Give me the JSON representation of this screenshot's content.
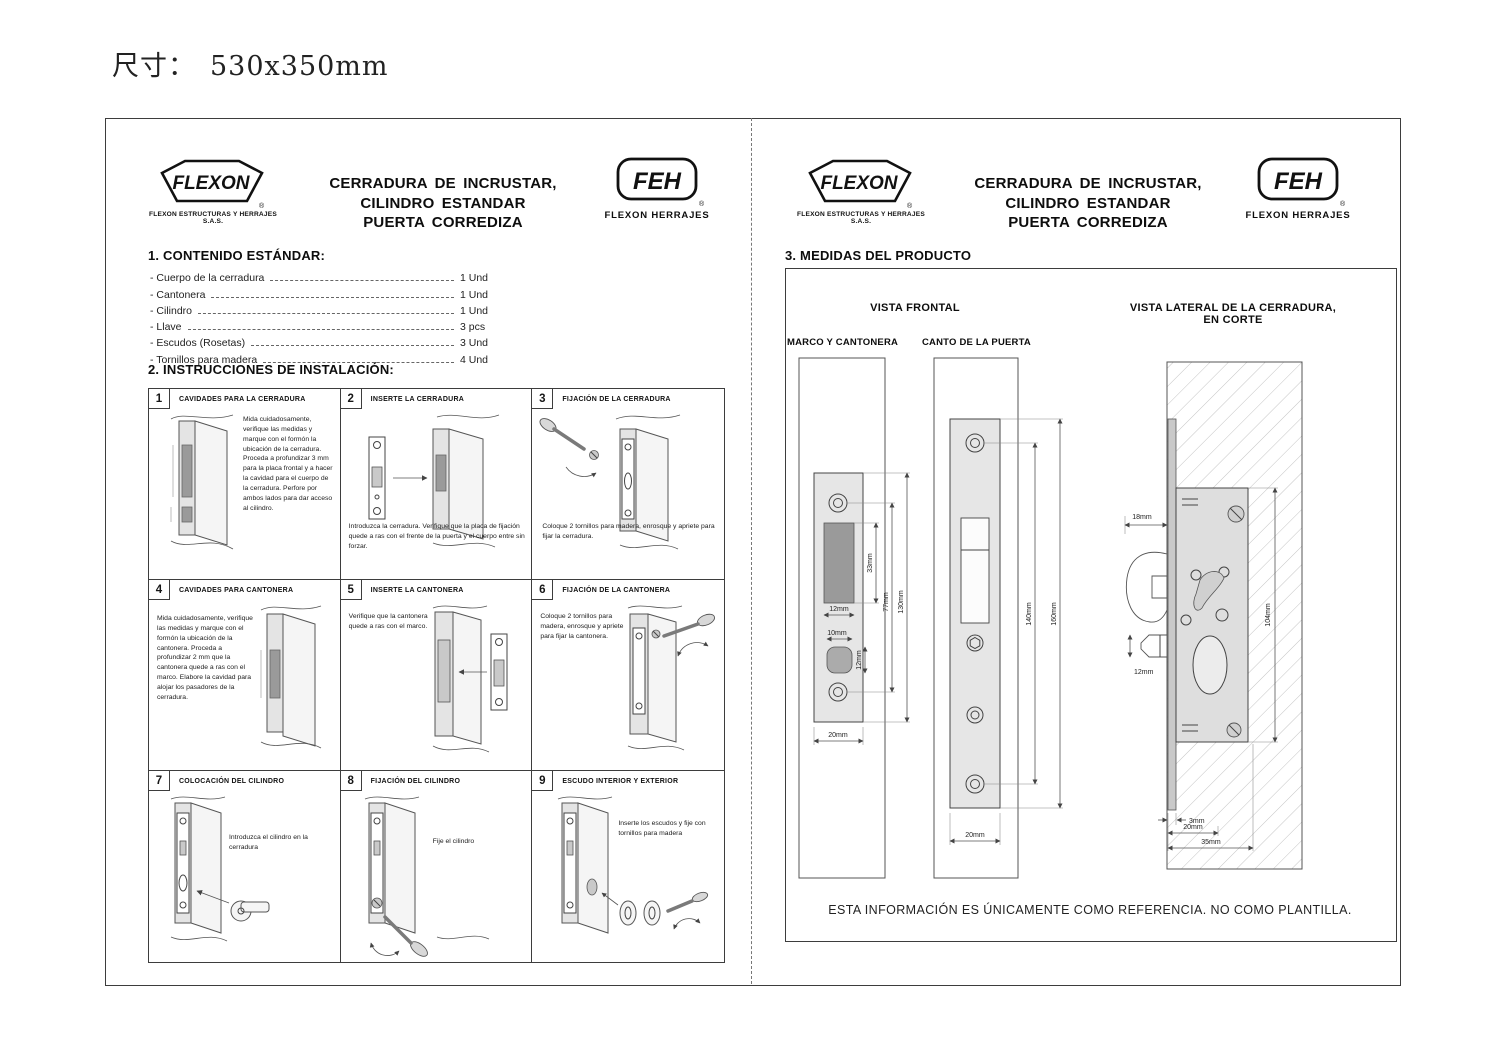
{
  "meta": {
    "size_label": "尺寸：",
    "size_value": "530x350mm"
  },
  "header": {
    "flexon_logo": "FLEXON",
    "flexon_sub": "FLEXON ESTRUCTURAS Y HERRAJES S.A.S.",
    "registered": "®",
    "title_line1": "CERRADURA DE INCRUSTAR,",
    "title_line2": "CILINDRO ESTANDAR",
    "title_line3": "PUERTA CORREDIZA",
    "feh_logo": "FEH",
    "feh_sub": "FLEXON HERRAJES"
  },
  "left_page": {
    "section1": {
      "title": "1. CONTENIDO ESTÁNDAR:",
      "items": [
        {
          "label": "Cuerpo de la cerradura",
          "qty": "1 Und"
        },
        {
          "label": "Cantonera",
          "qty": "1 Und"
        },
        {
          "label": "Cilindro",
          "qty": "1 Und"
        },
        {
          "label": "Llave",
          "qty": "3 pcs"
        },
        {
          "label": "Escudos (Rosetas)",
          "qty": "3 Und"
        },
        {
          "label": "Tornillos para madera",
          "qty": "4 Und"
        }
      ]
    },
    "section2": {
      "title": "2. INSTRUCCIONES DE INSTALACIÓN:",
      "steps": [
        {
          "num": "1",
          "title": "CAVIDADES PARA LA CERRADURA",
          "text": "Mida cuidadosamente, verifique las medidas y marque con el formón la ubicación de la cerradura. Proceda a profundizar 3 mm para la placa frontal y a hacer la cavidad para el cuerpo de la cerradura. Perfore por ambos lados para dar acceso al cilindro."
        },
        {
          "num": "2",
          "title": "INSERTE LA CERRADURA",
          "text": "Introduzca la cerradura. Verifique que la placa de fijación quede a ras con el frente de la puerta y el cuerpo entre sin forzar."
        },
        {
          "num": "3",
          "title": "FIJACIÓN DE LA CERRADURA",
          "text": "Coloque 2 tornillos para madera, enrosque y apriete para fijar la cerradura."
        },
        {
          "num": "4",
          "title": "CAVIDADES PARA CANTONERA",
          "text": "Mida cuidadosamente, verifique las medidas y marque con el formón la ubicación de la cantonera. Proceda a profundizar 2 mm que la cantonera quede a ras con el marco. Elabore la cavidad para alojar los pasadores de la cerradura."
        },
        {
          "num": "5",
          "title": "INSERTE LA CANTONERA",
          "text": "Verifique que la cantonera quede a ras con el marco."
        },
        {
          "num": "6",
          "title": "FIJACIÓN DE LA CANTONERA",
          "text": "Coloque 2 tornillos para madera, enrosque y apriete para fijar la cantonera."
        },
        {
          "num": "7",
          "title": "COLOCACIÓN DEL CILINDRO",
          "text": "Introduzca el cilindro en la cerradura"
        },
        {
          "num": "8",
          "title": "FIJACIÓN DEL CILINDRO",
          "text": "Fije el cilindro"
        },
        {
          "num": "9",
          "title": "ESCUDO INTERIOR Y EXTERIOR",
          "text": "Inserte los escudos y fije con tornillos para madera"
        }
      ]
    }
  },
  "right_page": {
    "section3_title": "3. MEDIDAS DEL PRODUCTO",
    "vista_frontal": "VISTA FRONTAL",
    "marco_label": "MARCO Y  CANTONERA",
    "canto_label": "CANTO DE LA PUERTA",
    "lateral_label_line1": "VISTA LATERAL DE LA CERRADURA,",
    "lateral_label_line2": "EN CORTE",
    "footer_note": "ESTA INFORMACIÓN ES ÚNICAMENTE COMO REFERENCIA. NO COMO PLANTILLA.",
    "dims": {
      "marco": {
        "slot_w": "12mm",
        "slot_h": "33mm",
        "screws_h": "77mm",
        "plate_h": "130mm",
        "hole_w": "10mm",
        "hole_h": "12mm",
        "plate_w": "20mm"
      },
      "canto": {
        "screws_h": "140mm",
        "plate_h": "160mm",
        "plate_w": "20mm"
      },
      "lateral": {
        "backset": "18mm",
        "latch_h": "12mm",
        "body_h": "104mm",
        "plate_t": "3mm",
        "depth_20": "20mm",
        "depth_35": "35mm"
      }
    }
  }
}
